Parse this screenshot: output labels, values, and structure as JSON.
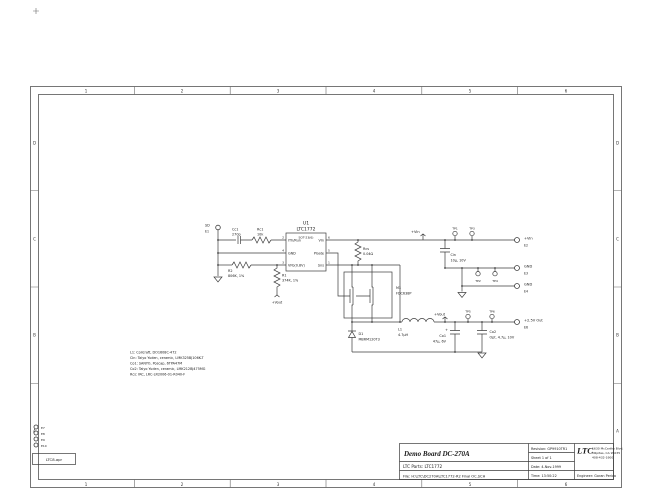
{
  "sheet": {
    "zone_cols": [
      "1",
      "2",
      "3",
      "4",
      "5",
      "6"
    ],
    "zone_rows": [
      "D",
      "C",
      "B",
      "A"
    ],
    "apr_label": "LTC8.apr",
    "spare_terminals": [
      "E7",
      "E8",
      "E9",
      "E10"
    ]
  },
  "title_block": {
    "title": "Demo Board DC-270A",
    "parts": "LTC Parts:  LTC1772",
    "file": "File: H:\\LTC\\DC270A\\LTC1772-R2 Final OC.SCH",
    "revision": "Revision: GP9910TR1",
    "sheet_of": "Sheet 1  of  1",
    "date": "Date: 4-Nov-1999",
    "time": "Time: 13:50:22",
    "logo": "LTC",
    "address1": "1630 McCarthy Blvd.",
    "address2": "Milpitas, CA 95035",
    "address3": "408-432-1900",
    "engineer": "Engineer: Goran Perica"
  },
  "notes": [
    "L1:  Coilcraft, DO1608C-472",
    "Cin:  Taiyo Yuden, ceramic, LMK325BJ106K-T",
    "Co1:  SANYO, Poscap, 6TPA47M",
    "Co2:  Taiyo Yuden, ceramic, LMK212BJ475MG",
    "Rcs:  IRC, LRC-LR2006-01-R040-F"
  ],
  "ic": {
    "ref": "U1",
    "part": "LTC1772",
    "package": "SOT-23(6)",
    "pins": {
      "ith": "ITh/Run",
      "gnd": "GND",
      "vfb": "VFb(0.8V)",
      "vin": "VIn",
      "pgate": "PGate",
      "sns": "Sns"
    },
    "pin_numbers": {
      "ith": "2",
      "gnd": "4",
      "vfb": "3",
      "vin": "6",
      "pgate": "5",
      "sns": "1"
    }
  },
  "components": {
    "cc1": {
      "ref": "Cc1",
      "value": "270p"
    },
    "rc1": {
      "ref": "Rc1",
      "value": "10k"
    },
    "r2": {
      "ref": "R2",
      "value": "806K, 1%"
    },
    "r1": {
      "ref": "R1",
      "value": "374K, 1%"
    },
    "rcs": {
      "ref": "Rcs",
      "value": "0.04Ω"
    },
    "m1": {
      "ref": "M1",
      "value": "FDC638P"
    },
    "d1": {
      "ref": "D1",
      "value": "MBRM120T3"
    },
    "l1": {
      "ref": "L1",
      "value": "4.7µH"
    },
    "cin": {
      "ref": "Cin",
      "value": "10µ, 10V"
    },
    "co1": {
      "ref": "Co1",
      "value": "47µ, 6V",
      "polarity": "+"
    },
    "co2": {
      "ref": "Co2",
      "value": "Opt. 4.7µ, 10V"
    }
  },
  "nets": {
    "vin": "+Vin",
    "vout": "+Vout",
    "vout_fb": "+Vout"
  },
  "terminals": {
    "sd": {
      "name": "SD",
      "id": "E1"
    },
    "vin": {
      "name": "+Vin",
      "id": "E2"
    },
    "gnd1": {
      "name": "GND",
      "id": "E3"
    },
    "gnd2": {
      "name": "GND",
      "id": "E4"
    },
    "vout": {
      "name": "+2.5V Out",
      "id": "E6"
    }
  },
  "testpoints": {
    "vin1": "TP1",
    "vin2": "TP3",
    "gnd1": "TP2",
    "gnd2": "TP4",
    "vout1": "TP5",
    "vout2": "TP6"
  },
  "colors": {
    "line": "#3c3c3c",
    "text": "#1a1a1a",
    "paper": "#ffffff"
  }
}
